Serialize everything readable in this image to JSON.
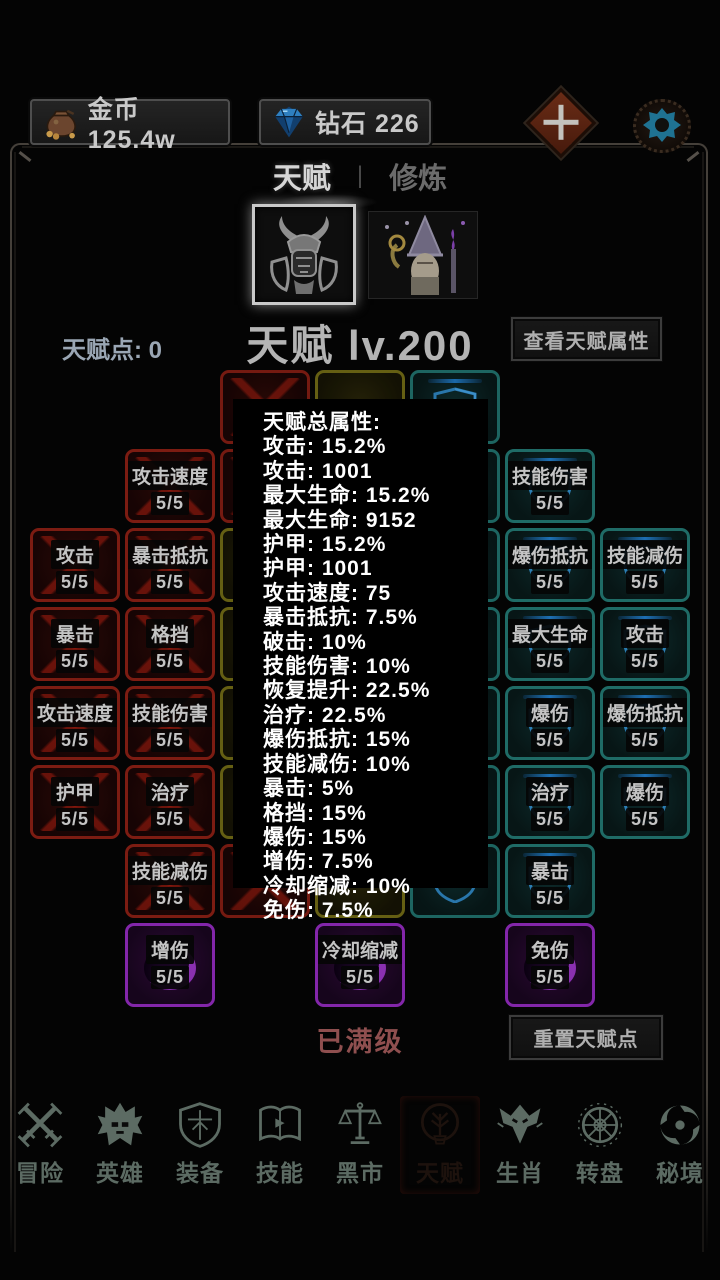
{
  "top_bar": {
    "gold_label": "金币 125.4w",
    "diamond_label": "钻石 226"
  },
  "tabs": {
    "talent": "天赋",
    "separator": "|",
    "cultivate": "修炼"
  },
  "header": {
    "points": "天赋点: 0",
    "title": "天赋 lv.200",
    "view_attrs_button": "查看天赋属性"
  },
  "popup_lines": [
    "天赋总属性:",
    "攻击: 15.2%",
    "攻击: 1001",
    "最大生命: 15.2%",
    "最大生命: 9152",
    "护甲: 15.2%",
    "护甲: 1001",
    "攻击速度: 75",
    "暴击抵抗: 7.5%",
    "破击: 10%",
    "技能伤害: 10%",
    "恢复提升: 22.5%",
    "治疗: 22.5%",
    "爆伤抵抗: 15%",
    "技能减伤: 10%",
    "暴击: 5%",
    "格挡: 15%",
    "爆伤: 15%",
    "增伤: 7.5%",
    "冷却缩减: 10%",
    "免伤: 7.5%"
  ],
  "tiles": [
    {
      "c": 1,
      "r": 1,
      "color": "red",
      "label": "攻击速度",
      "lv": "5/5"
    },
    {
      "c": 0,
      "r": 2,
      "color": "red",
      "label": "攻击",
      "lv": "5/5"
    },
    {
      "c": 1,
      "r": 2,
      "color": "red",
      "label": "暴击抵抗",
      "lv": "5/5"
    },
    {
      "c": 0,
      "r": 3,
      "color": "red",
      "label": "暴击",
      "lv": "5/5"
    },
    {
      "c": 1,
      "r": 3,
      "color": "red",
      "label": "格挡",
      "lv": "5/5"
    },
    {
      "c": 0,
      "r": 4,
      "color": "red",
      "label": "攻击速度",
      "lv": "5/5"
    },
    {
      "c": 1,
      "r": 4,
      "color": "red",
      "label": "技能伤害",
      "lv": "5/5"
    },
    {
      "c": 0,
      "r": 5,
      "color": "red",
      "label": "护甲",
      "lv": "5/5"
    },
    {
      "c": 1,
      "r": 5,
      "color": "red",
      "label": "治疗",
      "lv": "5/5"
    },
    {
      "c": 1,
      "r": 6,
      "color": "red",
      "label": "技能减伤",
      "lv": "5/5"
    },
    {
      "c": 5,
      "r": 1,
      "color": "teal",
      "label": "技能伤害",
      "lv": "5/5"
    },
    {
      "c": 5,
      "r": 2,
      "color": "teal",
      "label": "爆伤抵抗",
      "lv": "5/5"
    },
    {
      "c": 6,
      "r": 2,
      "color": "teal",
      "label": "技能减伤",
      "lv": "5/5"
    },
    {
      "c": 5,
      "r": 3,
      "color": "teal",
      "label": "最大生命",
      "lv": "5/5"
    },
    {
      "c": 6,
      "r": 3,
      "color": "teal",
      "label": "攻击",
      "lv": "5/5"
    },
    {
      "c": 5,
      "r": 4,
      "color": "teal",
      "label": "爆伤",
      "lv": "5/5"
    },
    {
      "c": 6,
      "r": 4,
      "color": "teal",
      "label": "爆伤抵抗",
      "lv": "5/5"
    },
    {
      "c": 5,
      "r": 5,
      "color": "teal",
      "label": "治疗",
      "lv": "5/5"
    },
    {
      "c": 6,
      "r": 5,
      "color": "teal",
      "label": "爆伤",
      "lv": "5/5"
    },
    {
      "c": 5,
      "r": 6,
      "color": "teal",
      "label": "暴击",
      "lv": "5/5"
    },
    {
      "c": 1,
      "r": 7,
      "color": "purple",
      "label": "增伤",
      "lv": "5/5"
    },
    {
      "c": 3,
      "r": 7,
      "color": "purple",
      "label": "冷却缩减",
      "lv": "5/5"
    },
    {
      "c": 5,
      "r": 7,
      "color": "purple",
      "label": "免伤",
      "lv": "5/5"
    },
    {
      "c": 2,
      "r": 0,
      "color": "red"
    },
    {
      "c": 3,
      "r": 0,
      "color": "yellow"
    },
    {
      "c": 4,
      "r": 0,
      "color": "teal"
    },
    {
      "c": 2,
      "r": 1,
      "color": "red"
    },
    {
      "c": 3,
      "r": 1,
      "color": "yellow"
    },
    {
      "c": 4,
      "r": 1,
      "color": "teal"
    },
    {
      "c": 2,
      "r": 2,
      "color": "yellow"
    },
    {
      "c": 3,
      "r": 2,
      "color": "yellow"
    },
    {
      "c": 4,
      "r": 2,
      "color": "teal"
    },
    {
      "c": 2,
      "r": 3,
      "color": "yellow"
    },
    {
      "c": 3,
      "r": 3,
      "color": "yellow"
    },
    {
      "c": 4,
      "r": 3,
      "color": "teal"
    },
    {
      "c": 2,
      "r": 4,
      "color": "yellow"
    },
    {
      "c": 3,
      "r": 4,
      "color": "yellow"
    },
    {
      "c": 4,
      "r": 4,
      "color": "teal"
    },
    {
      "c": 2,
      "r": 5,
      "color": "yellow"
    },
    {
      "c": 3,
      "r": 5,
      "color": "yellow"
    },
    {
      "c": 4,
      "r": 5,
      "color": "teal"
    },
    {
      "c": 2,
      "r": 6,
      "color": "red"
    },
    {
      "c": 3,
      "r": 6,
      "color": "yellow"
    },
    {
      "c": 4,
      "r": 6,
      "color": "teal"
    }
  ],
  "footer": {
    "maxed": "已满级",
    "reset_button": "重置天赋点"
  },
  "nav": [
    {
      "key": "adventure",
      "label": "冒险",
      "active": false
    },
    {
      "key": "hero",
      "label": "英雄",
      "active": false
    },
    {
      "key": "equipment",
      "label": "装备",
      "active": false
    },
    {
      "key": "skill",
      "label": "技能",
      "active": false
    },
    {
      "key": "market",
      "label": "黑市",
      "active": false
    },
    {
      "key": "talent",
      "label": "天赋",
      "active": true
    },
    {
      "key": "zodiac",
      "label": "生肖",
      "active": false
    },
    {
      "key": "wheel",
      "label": "转盘",
      "active": false
    },
    {
      "key": "realm",
      "label": "秘境",
      "active": false
    }
  ],
  "colors": {
    "red_tile_border": "#7c1c12",
    "teal_tile_border": "#1f6b66",
    "yellow_tile_border": "#6b6414",
    "purple_tile_border": "#8326aa",
    "nav_active_bg": "#5a2a20",
    "maxed_text": "#8f4f4f",
    "gear_teal": "#1f7292",
    "plus_btn_brown": "#6a2c16"
  }
}
